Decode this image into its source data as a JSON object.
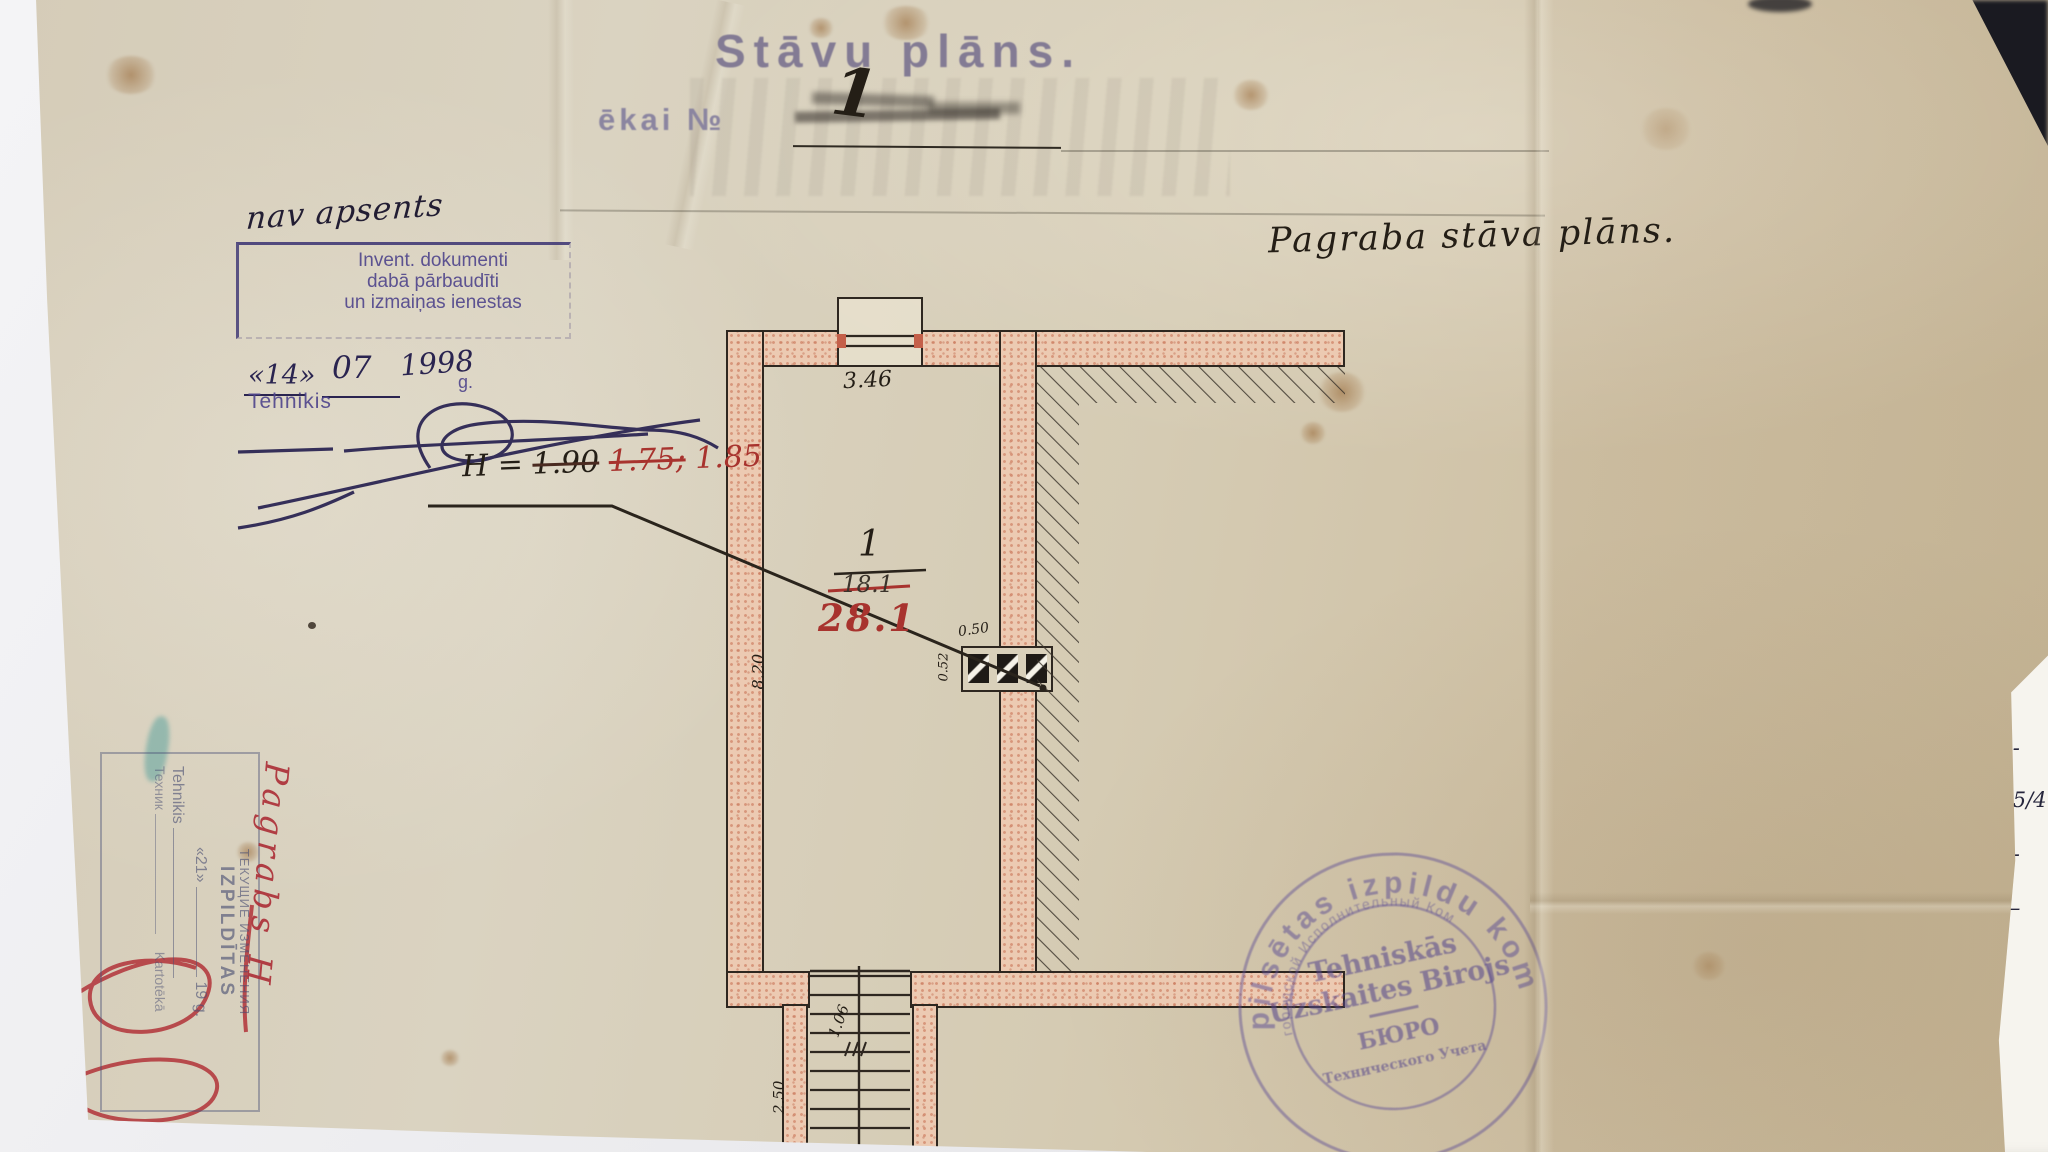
{
  "document": {
    "stamped_title": "Stāvu plāns.",
    "building_label": "ēkai №",
    "building_number": "1",
    "handwritten_note": "nav apsents",
    "plan_caption": "Pagraba stāva plāns."
  },
  "inspection_stamp": {
    "line1": "Invent. dokumenti",
    "line2": "dabā pārbaudīti",
    "line3": "un izmaiņas ienestas",
    "date_day": "«14»",
    "date_month": "07",
    "date_year": "1998",
    "date_suffix": "g.",
    "technician_label": "Tehnikis"
  },
  "height_annotation": {
    "prefix": "H =",
    "crossed_value": "1.90",
    "crossed_value2": "1.75;",
    "current_value": "1.85"
  },
  "room_label": {
    "number": "1",
    "old_area": "18.1",
    "new_area": "28.1"
  },
  "dimensions": {
    "top_width": "3.46",
    "left_height": "8.20",
    "flue_width": "0.50",
    "flue_depth": "0.52",
    "stair_width": "1.06",
    "stair_run": "2.50"
  },
  "changes_stamp": {
    "header_ru": "ТЕКУЩИЕ ИЗМЕНЕНИЯ",
    "header_lv": "IZPILDĪTAS",
    "date_day": "«21»",
    "date_tail": "19     g.",
    "technician_lv": "Tehnikis",
    "technician_ru": "Техник",
    "card_label": "Kartotēkā",
    "red_caption": "Pagrabs H"
  },
  "round_stamp": {
    "outer_ring": "pilsētas izpildu kom",
    "inner_ring": "городской Исполнительный Ком",
    "center1": "Tehniskās",
    "center2": "Uzskaites Birojs",
    "center3": "БЮРО",
    "center4": "Технического Учета"
  },
  "side_paper": {
    "entries": [
      "70-",
      "125/4",
      "25-",
      "1—",
      "7"
    ]
  }
}
